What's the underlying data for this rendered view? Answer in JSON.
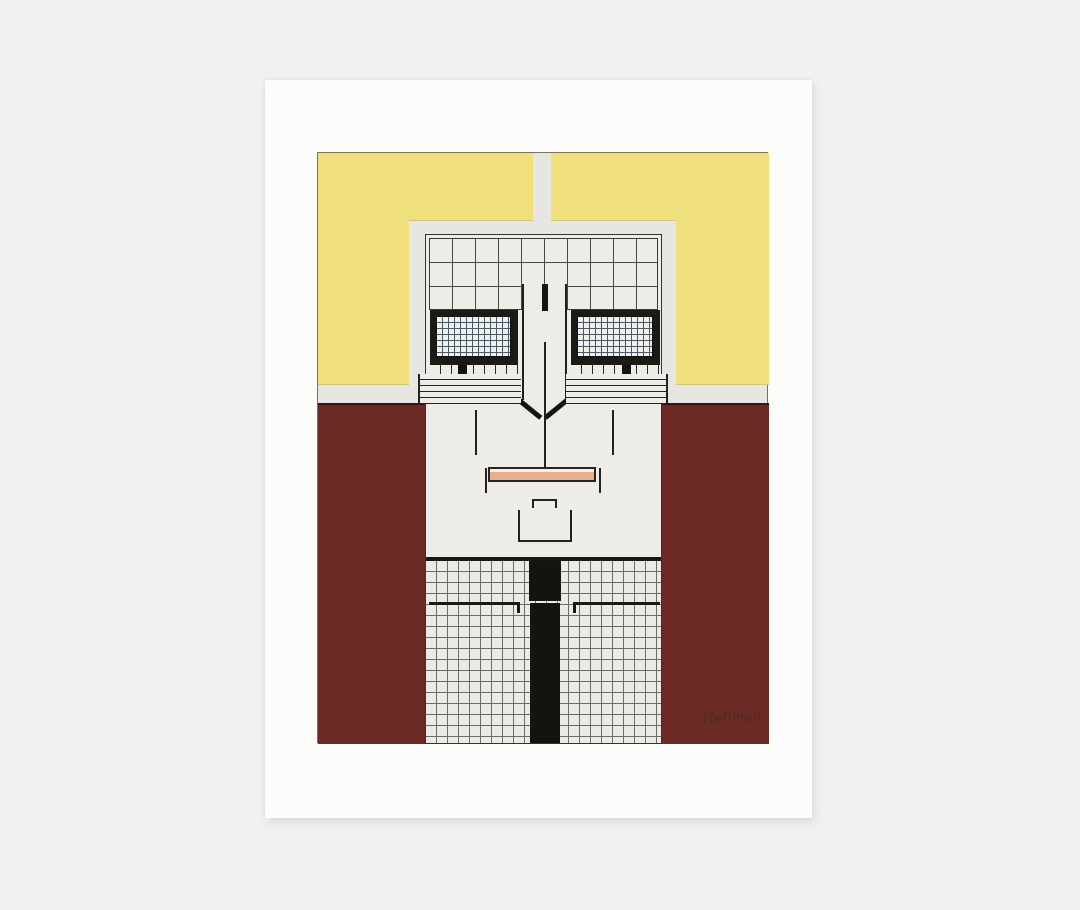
{
  "artwork": {
    "signature": "Hellman",
    "colors": {
      "background": "#f2f1ef",
      "card": "#fcfcfa",
      "yellow": "#f0e07c",
      "halo": "#e7e6e1",
      "face": "#edece7",
      "maroon": "#6b2b24",
      "ink": "#1b1a17",
      "lips": "#e7af8e",
      "eye_grid": "#4b5866"
    }
  }
}
